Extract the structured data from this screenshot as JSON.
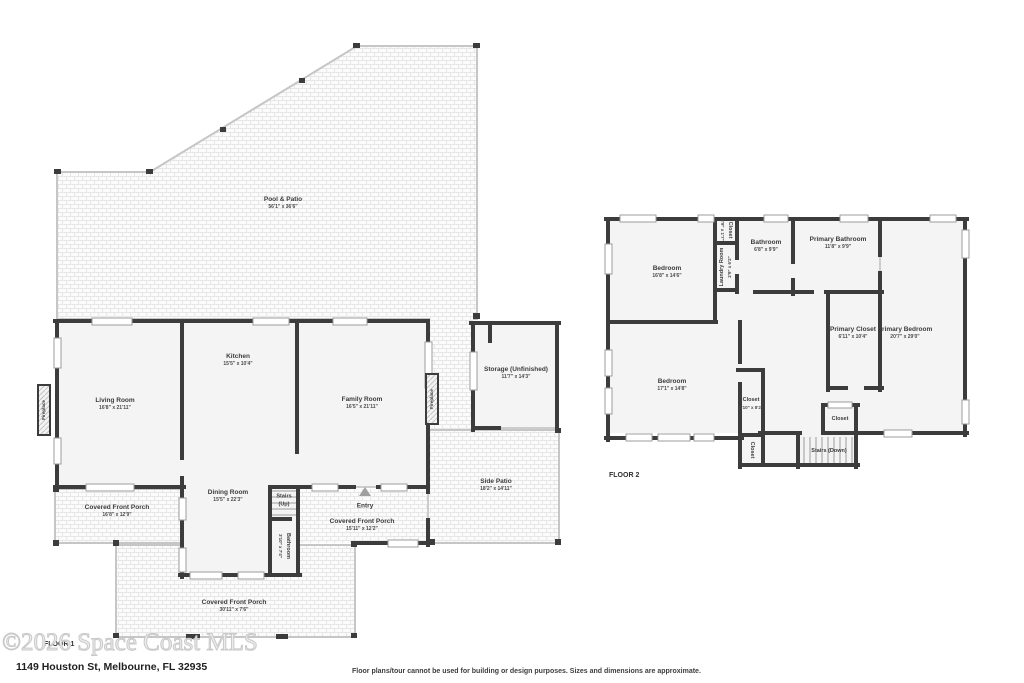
{
  "f1": {
    "label": "FLOOR 1",
    "pool": {
      "name": "Pool & Patio",
      "dims": "56'1\" x 36'6\""
    },
    "living": {
      "name": "Living Room",
      "dims": "16'8\" x 21'11\""
    },
    "kitchen": {
      "name": "Kitchen",
      "dims": "15'5\" x 10'4\""
    },
    "family": {
      "name": "Family Room",
      "dims": "16'5\" x 21'11\""
    },
    "storage": {
      "name": "Storage (Unfinished)",
      "dims": "11'7\" x 14'3\""
    },
    "side_patio": {
      "name": "Side Patio",
      "dims": "18'2\" x 14'11\""
    },
    "dining": {
      "name": "Dining Room",
      "dims": "15'5\" x 22'3\""
    },
    "stairs": {
      "name": "Stairs",
      "sub": "(Up)"
    },
    "entry": {
      "name": "Entry"
    },
    "bathroom": {
      "name": "Bathroom",
      "dims": "3'10\" x 7'4\""
    },
    "porch_left": {
      "name": "Covered Front Porch",
      "dims": "16'8\" x 12'9\""
    },
    "porch_entry": {
      "name": "Covered Front Porch",
      "dims": "15'11\" x 12'2\""
    },
    "porch_bottom": {
      "name": "Covered Front Porch",
      "dims": "30'11\" x 7'6\""
    },
    "fireplace": "Fireplace"
  },
  "f2": {
    "label": "FLOOR 2",
    "bedroom1": {
      "name": "Bedroom",
      "dims": "16'8\" x 14'6\""
    },
    "closet_top": {
      "name": "Closet",
      "dims": "2'9\" x 1'7\""
    },
    "laundry": {
      "name": "Laundry Room",
      "dims": "2'9\" x 6'2\""
    },
    "bathroom": {
      "name": "Bathroom",
      "dims": "6'8\" x 9'9\""
    },
    "primary_bathroom": {
      "name": "Primary Bathroom",
      "dims": "11'8\" x 9'9\""
    },
    "primary_closet": {
      "name": "Primary Closet",
      "dims": "6'11\" x 10'4\""
    },
    "primary_bedroom": {
      "name": "Primary Bedroom",
      "dims": "20'7\" x 29'0\""
    },
    "bedroom2": {
      "name": "Bedroom",
      "dims": "17'1\" x 14'8\""
    },
    "closet_mid": {
      "name": "Closet",
      "dims": "2'10\" x 8'2\""
    },
    "closet_low": {
      "name": "Closet"
    },
    "closet_stairs": {
      "name": "Closet"
    },
    "stairs": {
      "name": "Stairs (Down)"
    }
  },
  "footer": {
    "watermark": "©2026 Space Coast MLS",
    "address": "1149 Houston St, Melbourne, FL 32935",
    "disclaimer": "Floor plans/tour cannot be used for building or design purposes. Sizes and dimensions are approximate."
  },
  "palette": {
    "wall": "#3c3c3c",
    "room_fill": "#f4f4f4",
    "patio_line": "#c6c6c6",
    "text": "#3b3b3b"
  }
}
